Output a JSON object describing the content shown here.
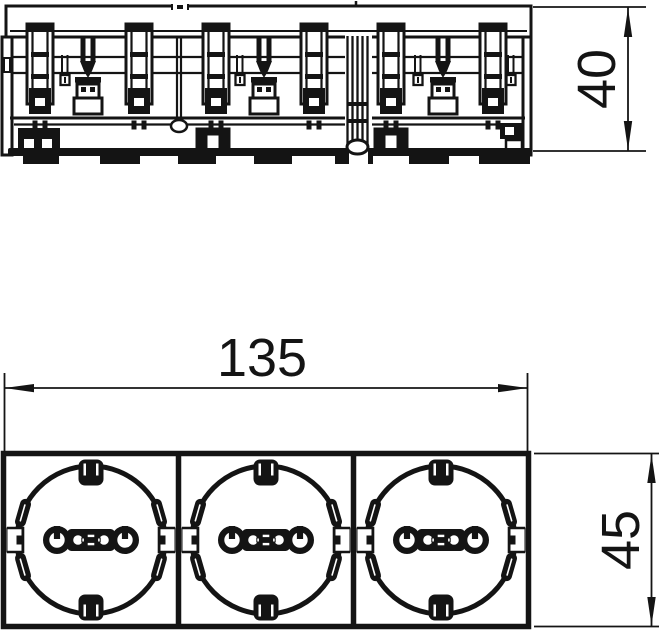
{
  "drawing": {
    "background_color": "#ffffff",
    "line_color": "#141414",
    "dimensions": {
      "width_label": "135",
      "height_label": "45",
      "depth_label": "40"
    },
    "front_view": {
      "socket_count": 3
    }
  }
}
